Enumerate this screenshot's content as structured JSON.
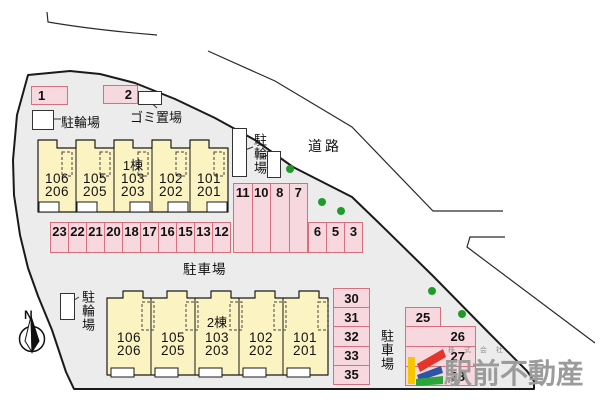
{
  "site": {
    "road_label": "道路",
    "north_label": "N",
    "garbage": {
      "label": "ゴミ置場"
    },
    "bike_nw": {
      "label": "駐輪場"
    },
    "bike_ne": {
      "label": "駐輪場"
    },
    "bike_sw": {
      "label": "駐輪場"
    },
    "parking_lot_label_main": "駐車場",
    "parking_lot_label_south": "駐車場",
    "spots": {
      "north": [
        "1",
        "2"
      ],
      "row_main": [
        "23",
        "22",
        "21",
        "20",
        "18",
        "17",
        "16",
        "15",
        "13",
        "12"
      ],
      "block_tall": [
        "11",
        "10",
        "8",
        "7"
      ],
      "block_small": [
        "6",
        "5",
        "3"
      ],
      "col_west": [
        "30",
        "31",
        "32",
        "33",
        "35"
      ],
      "col_east": [
        "25",
        "26",
        "27",
        "28"
      ]
    },
    "building1": {
      "name": "1棟",
      "units": [
        {
          "upper": "106",
          "lower": "206"
        },
        {
          "upper": "105",
          "lower": "205"
        },
        {
          "upper": "103",
          "lower": "203"
        },
        {
          "upper": "102",
          "lower": "202"
        },
        {
          "upper": "101",
          "lower": "201"
        }
      ]
    },
    "building2": {
      "name": "2棟",
      "units": [
        {
          "upper": "106",
          "lower": "206"
        },
        {
          "upper": "105",
          "lower": "205"
        },
        {
          "upper": "103",
          "lower": "203"
        },
        {
          "upper": "102",
          "lower": "202"
        },
        {
          "upper": "101",
          "lower": "201"
        }
      ]
    },
    "logo": {
      "company_type": "株 式 会 社",
      "company_name": "駅前不動産"
    },
    "colors": {
      "site_fill": "#ececec",
      "spot_fill": "#f8d8df",
      "spot_border": "#d5707e",
      "building_fill": "#fbf3c2",
      "tree_green": "#1e9b29",
      "logo_gray": "#9b9b9b",
      "logo_yellow": "#f6c600",
      "logo_red": "#e33529",
      "logo_blue": "#2b55a5",
      "logo_green": "#2aa53a"
    }
  }
}
